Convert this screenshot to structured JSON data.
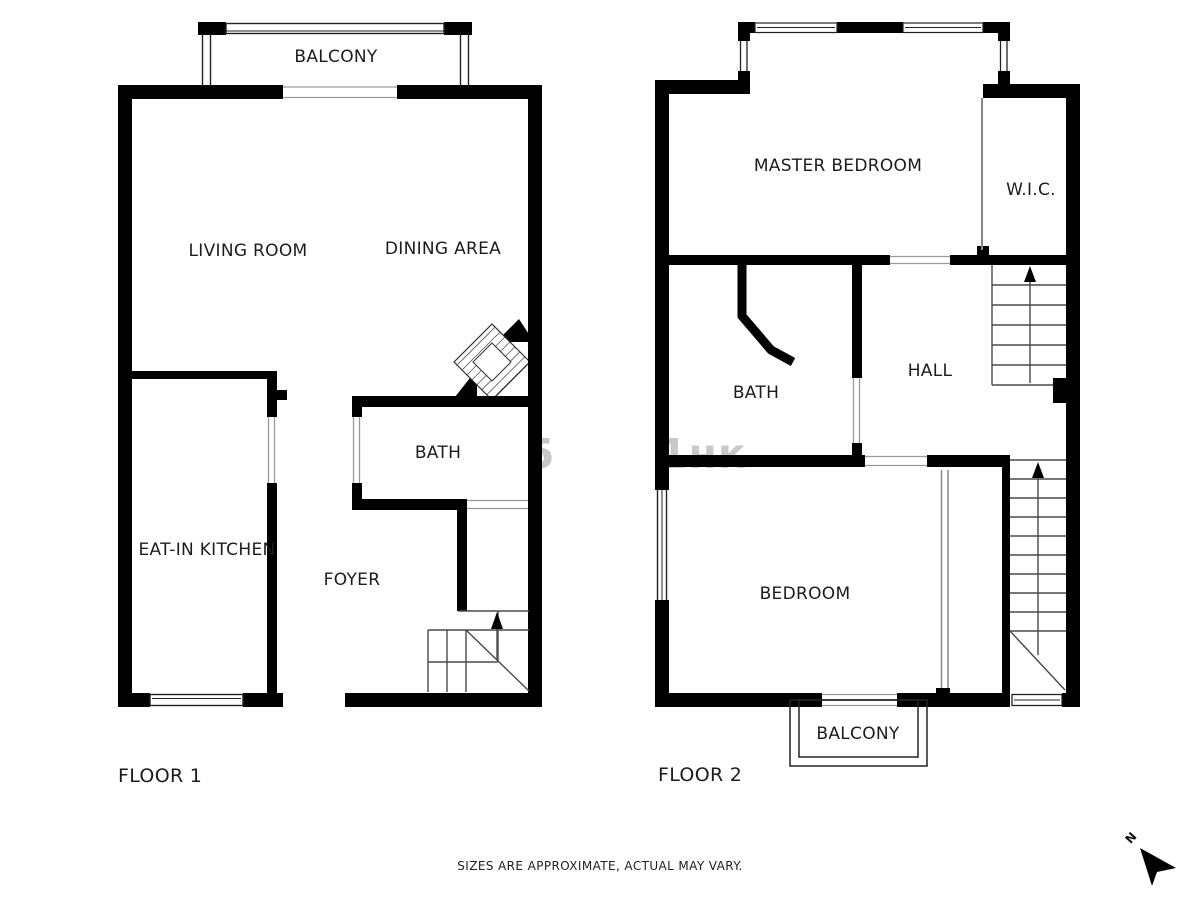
{
  "page": {
    "footer_note": "SIZES ARE APPROXIMATE, ACTUAL MAY VARY.",
    "compass_label": "N"
  },
  "watermark": {
    "fragment_left": "5",
    "fragment_right": "1нк",
    "color": "#c8c8c8"
  },
  "floor1": {
    "title": "FLOOR 1",
    "rooms": {
      "balcony": "BALCONY",
      "living_room": "LIVING ROOM",
      "dining_area": "DINING AREA",
      "bath": "BATH",
      "eat_in_kitchen": "EAT-IN KITCHEN",
      "foyer": "FOYER"
    }
  },
  "floor2": {
    "title": "FLOOR 2",
    "rooms": {
      "master_bedroom": "MASTER BEDROOM",
      "wic": "W.I.C.",
      "bath": "BATH",
      "hall": "HALL",
      "bedroom": "BEDROOM",
      "balcony": "BALCONY"
    }
  },
  "colors": {
    "wall": "#000000",
    "stair_line": "#4a4a4a",
    "opening_line": "#9a9a9a",
    "window_line": "#222222"
  }
}
